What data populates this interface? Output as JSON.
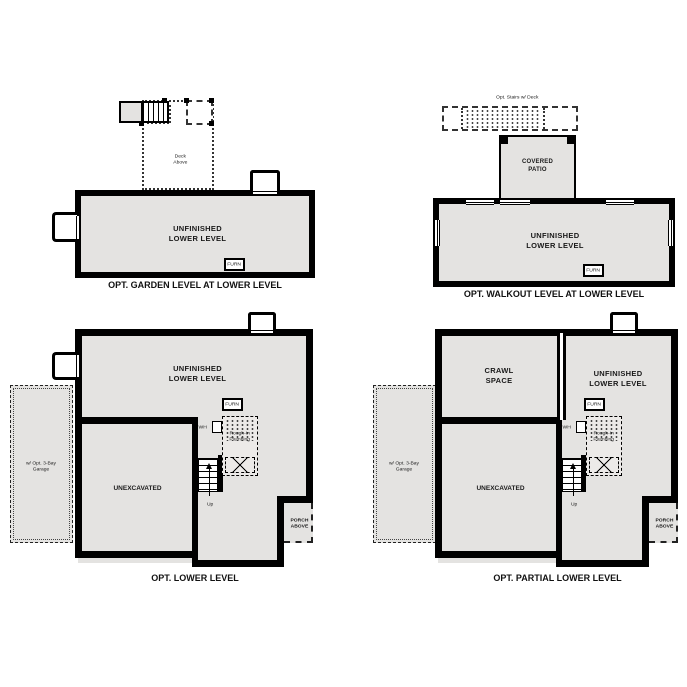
{
  "colors": {
    "wall": "#000000",
    "room_fill": "#e4e3e1",
    "background": "#ffffff",
    "dashed_line": "#333333"
  },
  "plans": {
    "garden": {
      "caption": "OPT. GARDEN LEVEL AT LOWER LEVEL",
      "room_label": "UNFINISHED\nLOWER LEVEL",
      "furnace_label": "FURN",
      "deck_label": "Deck\nAbove"
    },
    "walkout": {
      "caption": "OPT. WALKOUT LEVEL AT LOWER LEVEL",
      "room_label": "UNFINISHED\nLOWER LEVEL",
      "furnace_label": "FURN",
      "patio_label": "COVERED\nPATIO",
      "deck_label": "Opt. Stairs w/ Deck"
    },
    "lower": {
      "caption": "OPT. LOWER LEVEL",
      "room_label": "UNFINISHED\nLOWER LEVEL",
      "furnace_label": "FURN",
      "unexcavated_label": "UNEXCAVATED",
      "water_heater_label": "WH",
      "rough_in_label": "Rough-In\nPlumbing",
      "stairs_label": "Up",
      "garage_label": "w/ Opt. 3-Bay Garage",
      "porch_label": "PORCH\nABOVE"
    },
    "partial": {
      "caption": "OPT. PARTIAL LOWER LEVEL",
      "crawl_label": "CRAWL\nSPACE",
      "room_label": "UNFINISHED\nLOWER LEVEL",
      "furnace_label": "FURN",
      "unexcavated_label": "UNEXCAVATED",
      "water_heater_label": "WH",
      "rough_in_label": "Rough-In\nPlumbing",
      "stairs_label": "Up",
      "garage_label": "w/ Opt. 3-Bay Garage",
      "porch_label": "PORCH\nABOVE"
    }
  }
}
